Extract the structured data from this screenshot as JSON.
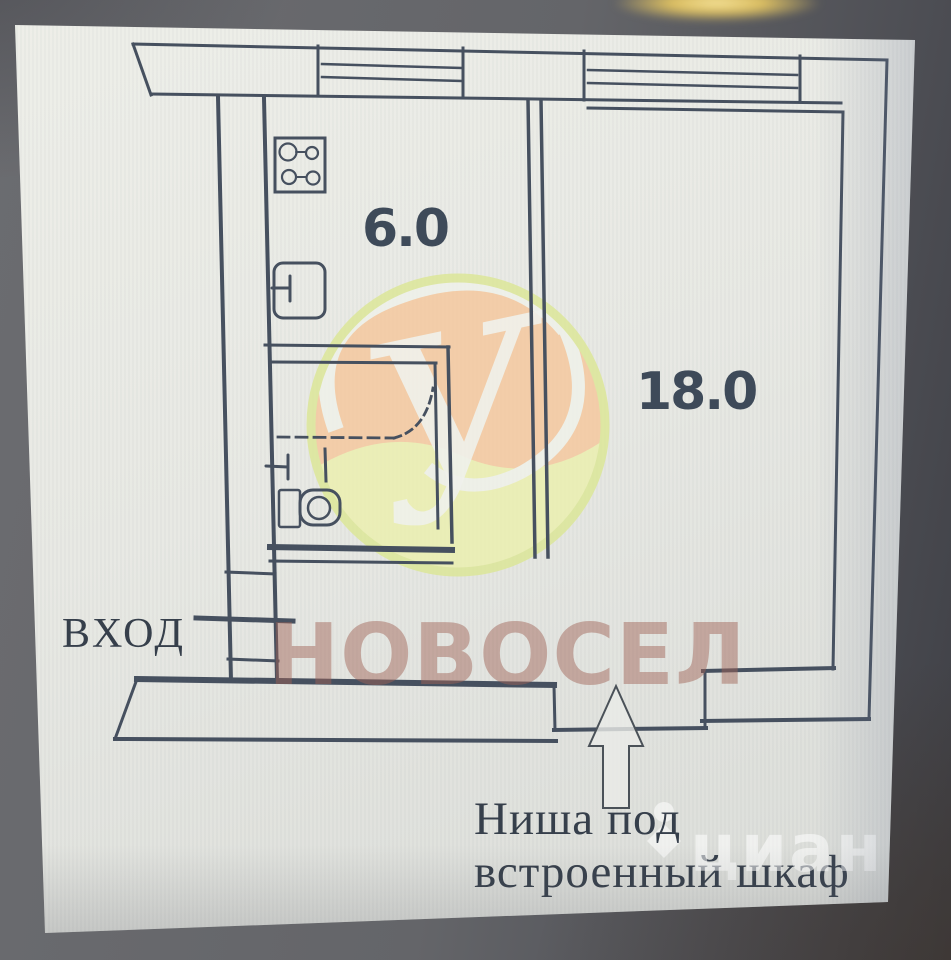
{
  "photo": {
    "description": "photographed apartment floor plan",
    "paper_color": "#e8e9e4",
    "surround_color": "#636468",
    "ink_color": "#46505f"
  },
  "plan": {
    "room_labels": {
      "kitchen": "6.0",
      "living_room": "18.0"
    },
    "entrance_label": "ВХОД",
    "niche_note_line1": "Ниша под",
    "niche_note_line2": "встроенный шкаф"
  },
  "watermarks": {
    "agency_name": "НОВОСЕЛ",
    "agency_color": "#c7a196",
    "logo_monogram": "У",
    "logo_ring_color": "#dce794",
    "logo_orange": "#f6c79b",
    "logo_green": "#ecf0ad",
    "portal_name": "циан",
    "portal_color": "#ffffff"
  }
}
